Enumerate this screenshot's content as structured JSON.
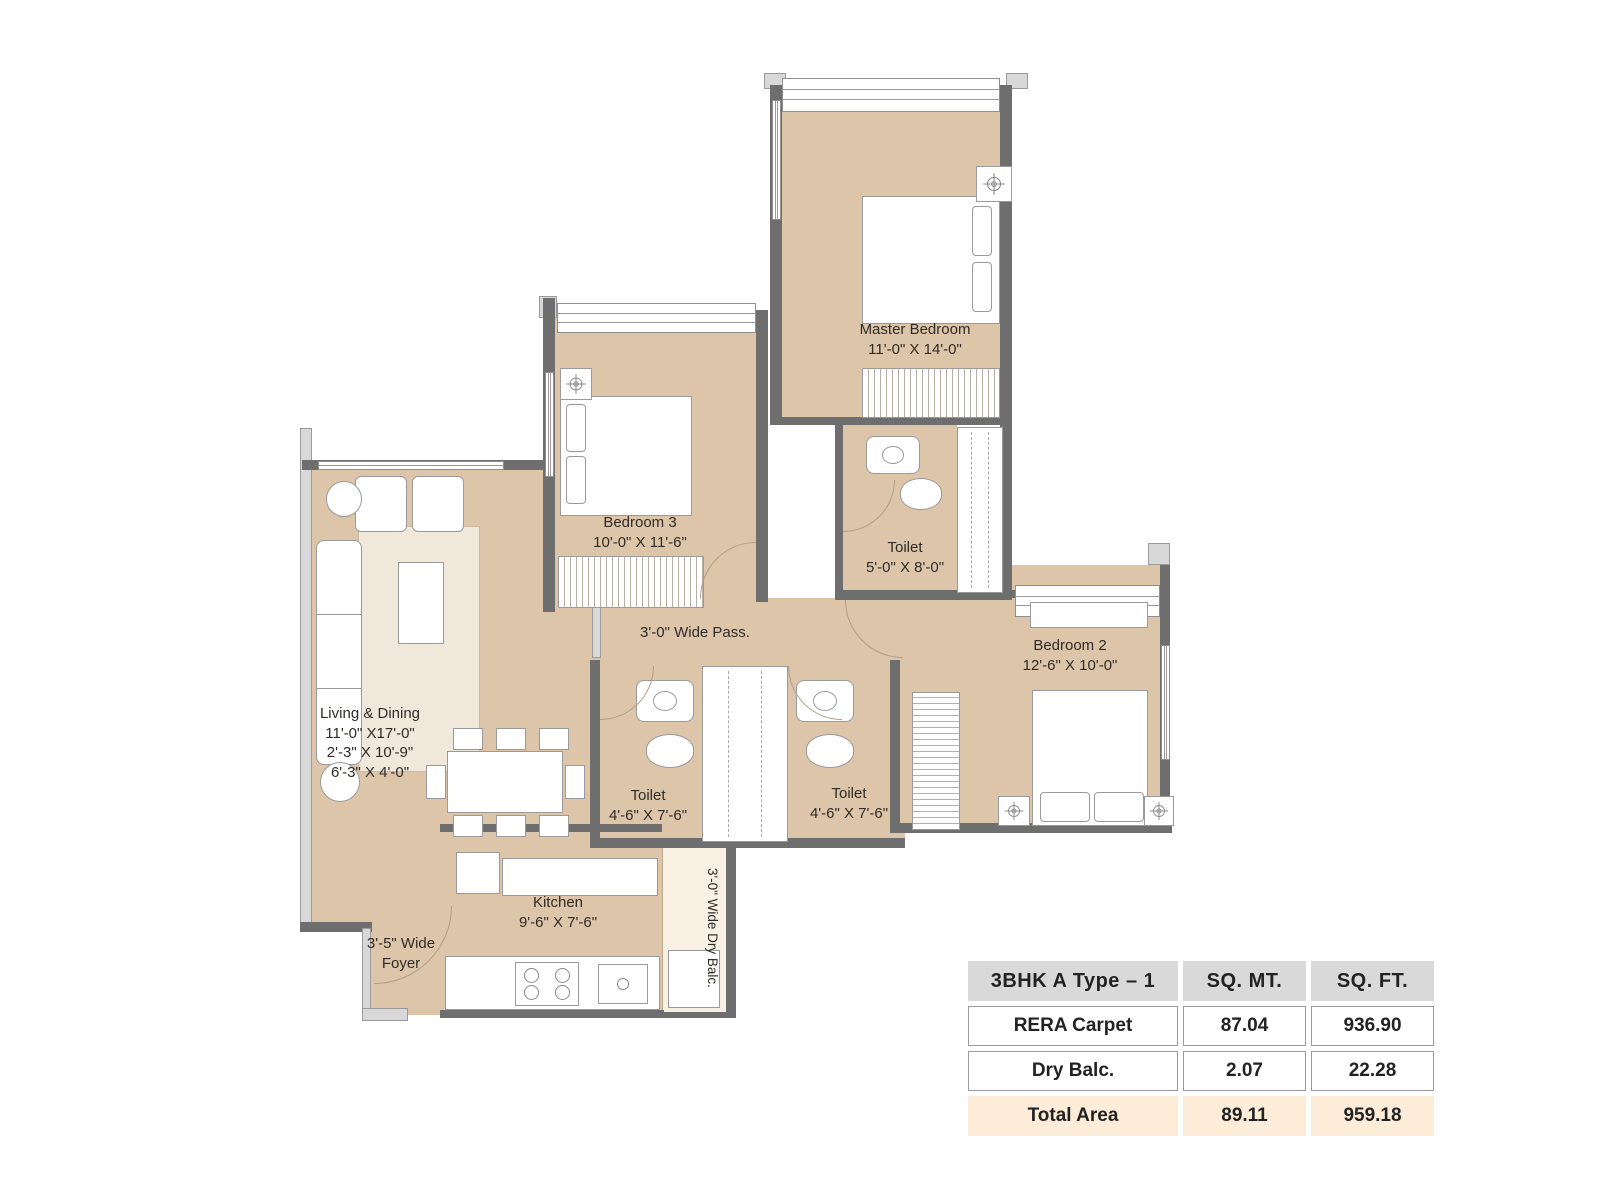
{
  "rooms": {
    "master_bedroom": {
      "name": "Master Bedroom",
      "dims": "11'-0\" X 14'-0\""
    },
    "bedroom_3": {
      "name": "Bedroom 3",
      "dims": "10'-0\" X 11'-6\""
    },
    "bedroom_2": {
      "name": "Bedroom 2",
      "dims": "12'-6\" X 10'-0\""
    },
    "master_toilet": {
      "name": "Toilet",
      "dims": "5'-0\" X 8'-0\""
    },
    "toilet_left": {
      "name": "Toilet",
      "dims": "4'-6\" X 7'-6\""
    },
    "toilet_right": {
      "name": "Toilet",
      "dims": "4'-6\" X 7'-6\""
    },
    "living_dining": {
      "name": "Living & Dining",
      "dims_1": "11'-0\" X17'-0\"",
      "dims_2": "2'-3\" X 10'-9\"",
      "dims_3": "6'-3\" X 4'-0\""
    },
    "kitchen": {
      "name": "Kitchen",
      "dims": "9'-6\" X 7'-6\""
    },
    "passage": {
      "label": "3'-0\" Wide Pass."
    },
    "foyer": {
      "label": "3'-5\" Wide Foyer"
    },
    "dry_balcony": {
      "label": "3'-0\" Wide Dry Balc."
    }
  },
  "area_table": {
    "header": {
      "plan_type": "3BHK A Type – 1",
      "sq_mt": "SQ. MT.",
      "sq_ft": "SQ. FT."
    },
    "rows": [
      {
        "label": "RERA Carpet",
        "sq_mt": "87.04",
        "sq_ft": "936.90"
      },
      {
        "label": "Dry Balc.",
        "sq_mt": "2.07",
        "sq_ft": "22.28"
      },
      {
        "label": "Total Area",
        "sq_mt": "89.11",
        "sq_ft": "959.18"
      }
    ]
  },
  "colors": {
    "floor": "#ddc5a9",
    "wall_dark": "#6e6e6e",
    "wall_light": "#d8d8d8",
    "rug": "#f0e8db",
    "balcony_floor": "#f8f1e3",
    "table_header_bg": "#d9d9d9",
    "table_total_bg": "#fcecd8"
  }
}
